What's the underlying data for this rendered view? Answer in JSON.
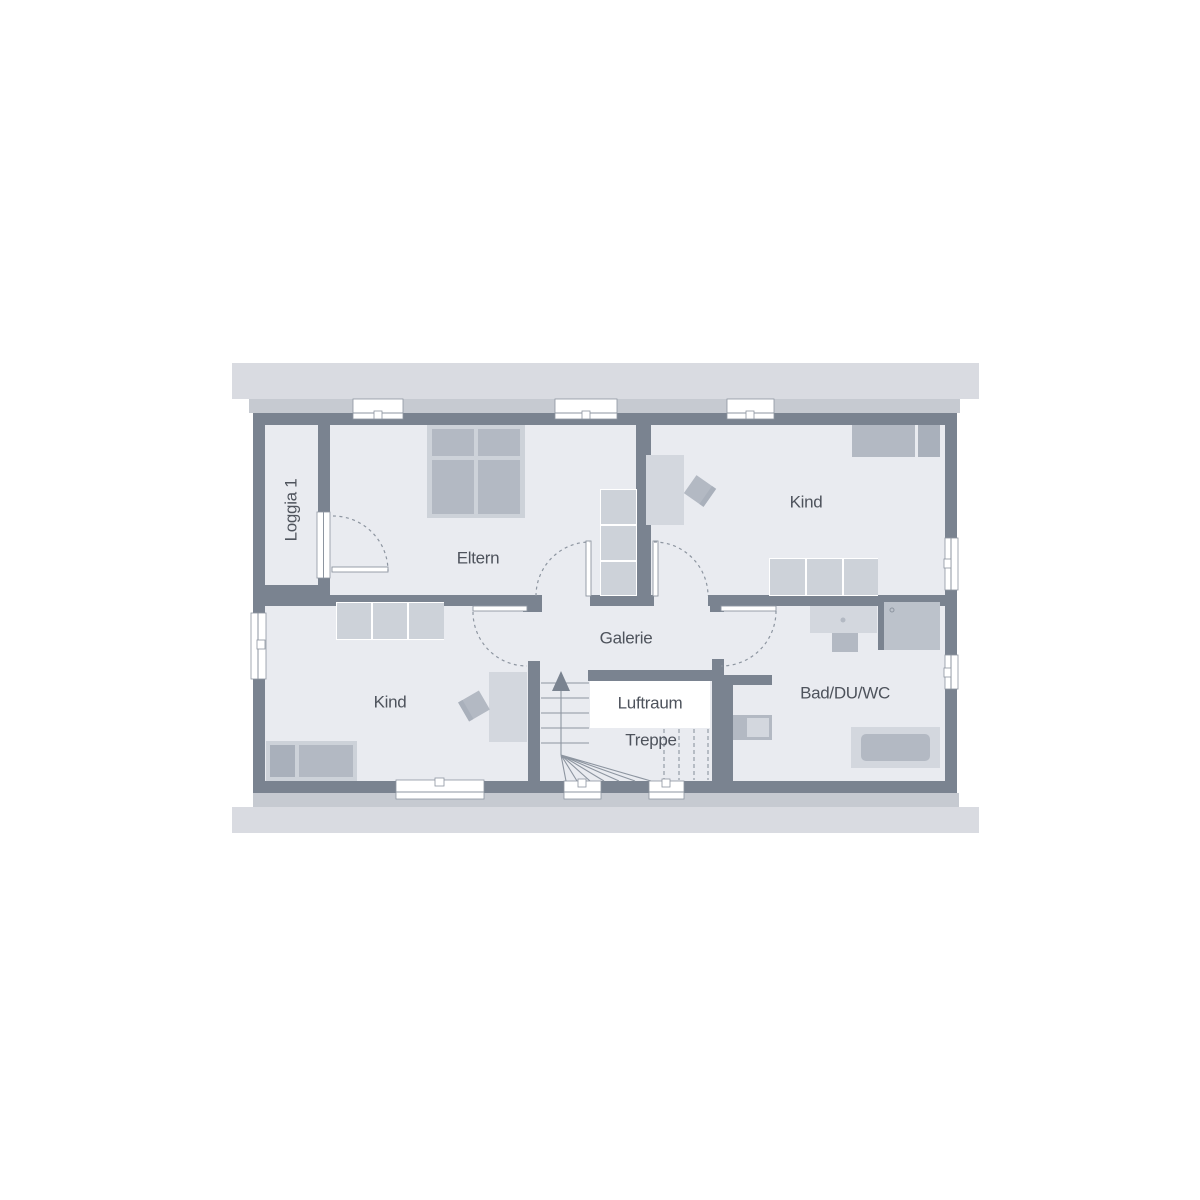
{
  "palette": {
    "page_bg": "#ffffff",
    "roof_band": "#d9dbe1",
    "eaves_strip": "#c6cad1",
    "wall": "#7a8390",
    "floor": "#e9ebf0",
    "furniture_light": "#d3d7de",
    "furniture_medium": "#b3b9c3",
    "wardrobe": "#cdd2d9",
    "pillow": "#a9b0bb",
    "void_white": "#ffffff",
    "shower_tray": "#bcc2cb",
    "line": "#8d95a0",
    "text": "#4e535c"
  },
  "rooms": [
    {
      "id": "loggia1",
      "label": "Loggia 1"
    },
    {
      "id": "eltern",
      "label": "Eltern"
    },
    {
      "id": "kind_oben",
      "label": "Kind"
    },
    {
      "id": "galerie",
      "label": "Galerie"
    },
    {
      "id": "kind_unten",
      "label": "Kind"
    },
    {
      "id": "luftraum",
      "label": "Luftraum"
    },
    {
      "id": "treppe",
      "label": "Treppe"
    },
    {
      "id": "bad_du_wc",
      "label": "Bad/DU/WC"
    }
  ]
}
